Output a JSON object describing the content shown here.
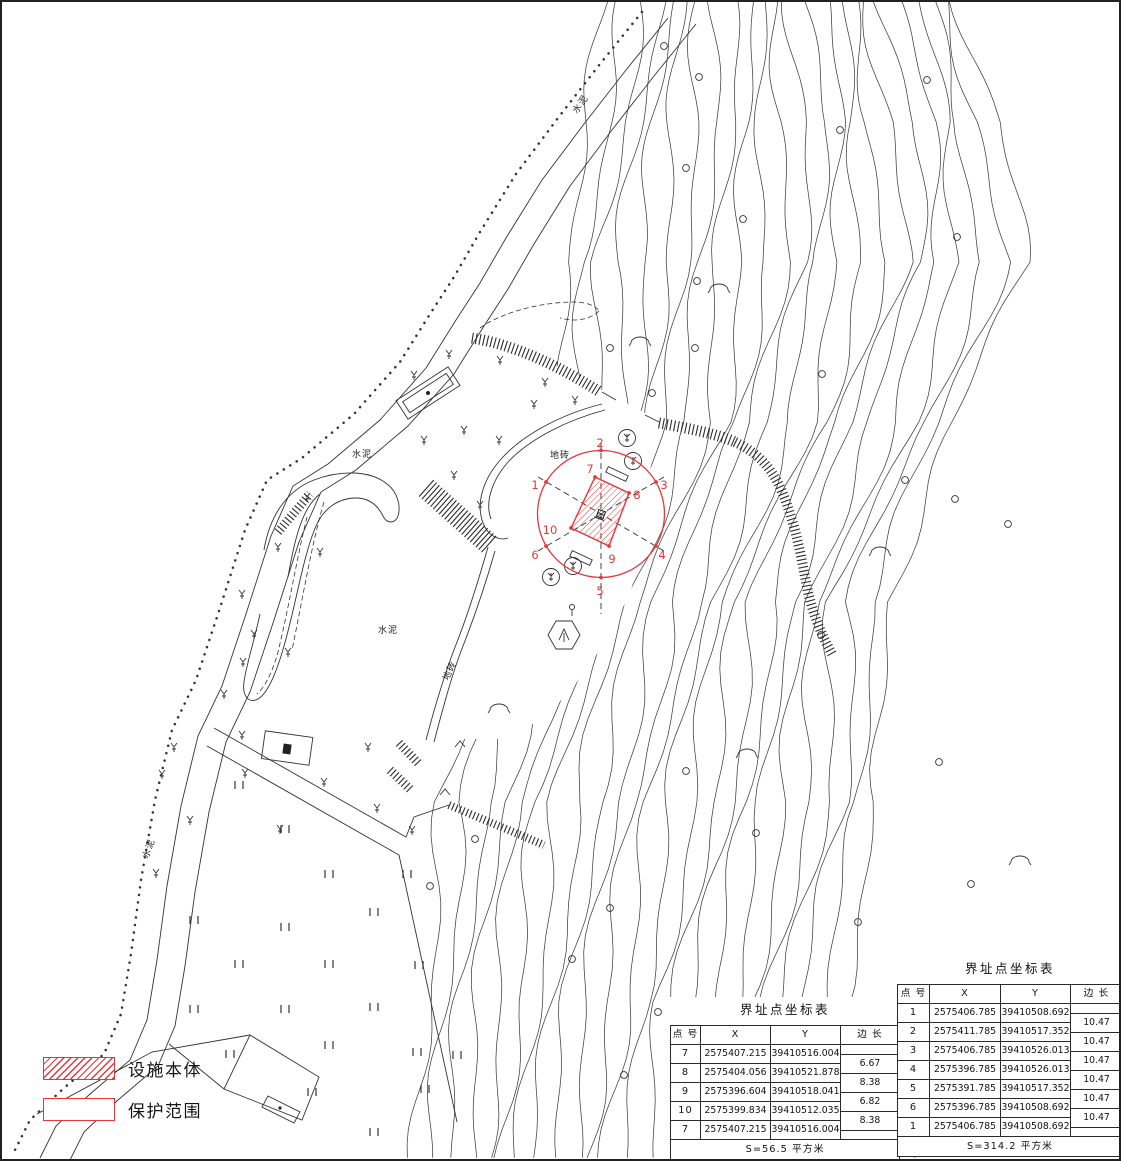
{
  "colors": {
    "red": "#e5383d",
    "line": "#3f3f3f"
  },
  "legend": {
    "items": [
      {
        "label": "设施本体",
        "swatch": "hatched-red"
      },
      {
        "label": "保护范围",
        "swatch": "red-outline"
      }
    ]
  },
  "map_labels": {
    "cement": "水泥",
    "paving": "地砖"
  },
  "survey_points": {
    "protection": [
      "1",
      "2",
      "3",
      "4",
      "5",
      "6"
    ],
    "facility": [
      "7",
      "8",
      "9",
      "10"
    ]
  },
  "tables": [
    {
      "title": "界址点坐标表",
      "headers": [
        "点 号",
        "X",
        "Y",
        "边 长"
      ],
      "rows": [
        [
          "7",
          "2575407.215",
          "39410516.004"
        ],
        [
          "8",
          "2575404.056",
          "39410521.878"
        ],
        [
          "9",
          "2575396.604",
          "39410518.041"
        ],
        [
          "10",
          "2575399.834",
          "39410512.035"
        ],
        [
          "7",
          "2575407.215",
          "39410516.004"
        ]
      ],
      "edges": [
        "6.67",
        "8.38",
        "6.82",
        "8.38"
      ],
      "footer": "S=56.5 平方米"
    },
    {
      "title": "界址点坐标表",
      "headers": [
        "点 号",
        "X",
        "Y",
        "边 长"
      ],
      "rows": [
        [
          "1",
          "2575406.785",
          "39410508.692"
        ],
        [
          "2",
          "2575411.785",
          "39410517.352"
        ],
        [
          "3",
          "2575406.785",
          "39410526.013"
        ],
        [
          "4",
          "2575396.785",
          "39410526.013"
        ],
        [
          "5",
          "2575391.785",
          "39410517.352"
        ],
        [
          "6",
          "2575396.785",
          "39410508.692"
        ],
        [
          "1",
          "2575406.785",
          "39410508.692"
        ]
      ],
      "edges": [
        "10.47",
        "10.47",
        "10.47",
        "10.47",
        "10.47",
        "10.47"
      ],
      "footer": "S=314.2 平方米"
    }
  ]
}
